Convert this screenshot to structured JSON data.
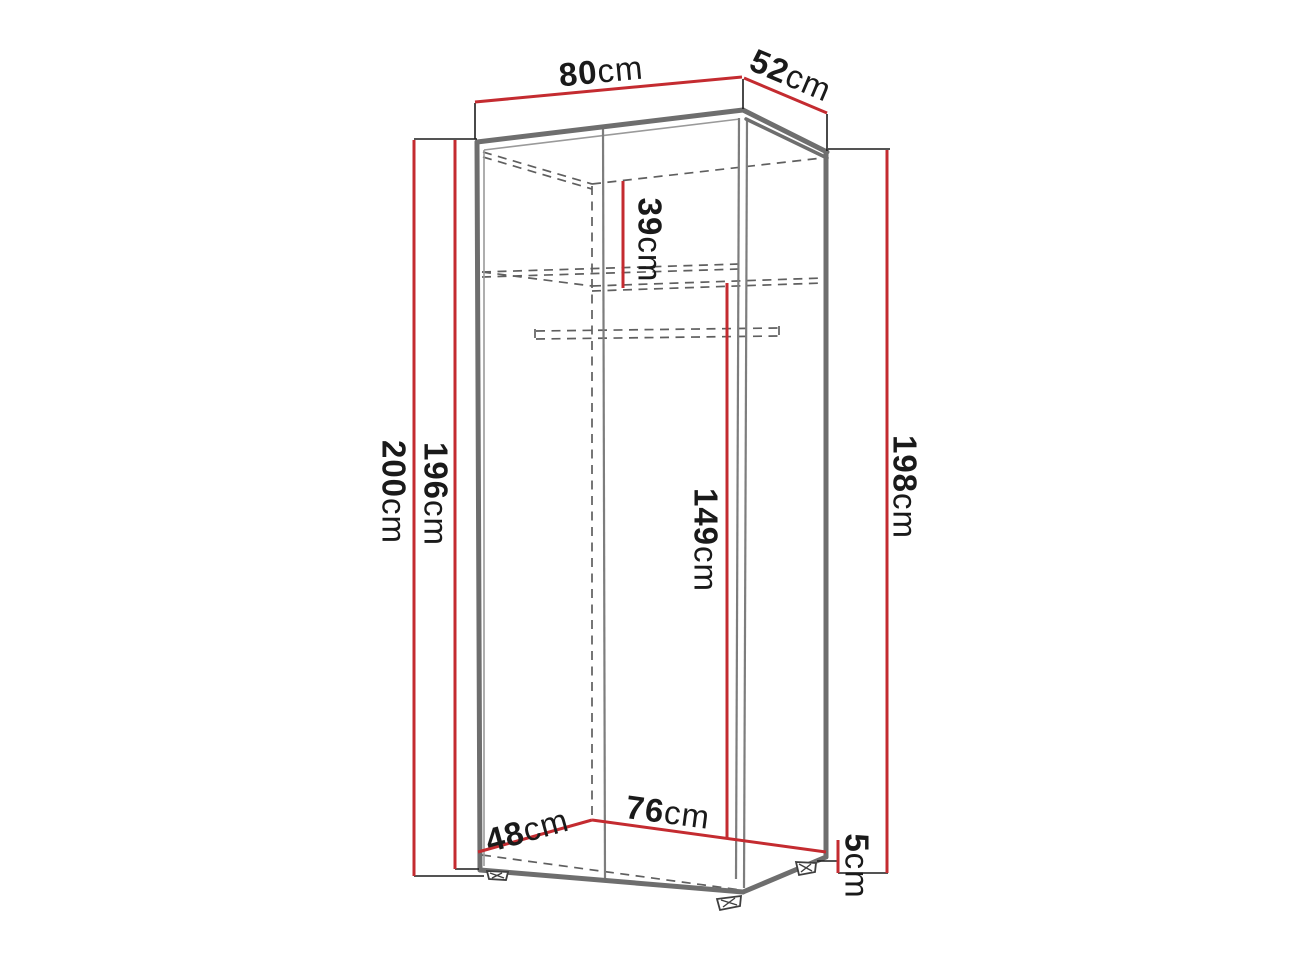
{
  "diagram": {
    "type": "furniture-dimension-diagram",
    "subject": "tall two-door wardrobe shown in perspective with dimension callouts",
    "unit": "cm",
    "colors": {
      "dimension_red": "#c42b30",
      "outline_gray": "#6e6e6e",
      "inner_gray": "#9a9a9a",
      "dashed_gray": "#5f5f5f",
      "extension_black": "#1c1c1c",
      "text_black": "#1a1a1a",
      "background": "#ffffff"
    },
    "dimensions": {
      "width_top": {
        "value": "80",
        "unit": "cm",
        "meaning": "overall top width"
      },
      "depth_top": {
        "value": "52",
        "unit": "cm",
        "meaning": "overall top depth"
      },
      "height_total": {
        "value": "200",
        "unit": "cm",
        "meaning": "overall height with feet"
      },
      "height_body": {
        "value": "196",
        "unit": "cm",
        "meaning": "carcass height at front left"
      },
      "height_right": {
        "value": "198",
        "unit": "cm",
        "meaning": "height at right side"
      },
      "top_section": {
        "value": "39",
        "unit": "cm",
        "meaning": "upper shelf compartment height"
      },
      "hanging_space": {
        "value": "149",
        "unit": "cm",
        "meaning": "interior height below shelf"
      },
      "depth_bottom": {
        "value": "48",
        "unit": "cm",
        "meaning": "interior floor depth"
      },
      "width_bottom": {
        "value": "76",
        "unit": "cm",
        "meaning": "interior floor width"
      },
      "feet_height": {
        "value": "5",
        "unit": "cm",
        "meaning": "foot height"
      }
    }
  }
}
